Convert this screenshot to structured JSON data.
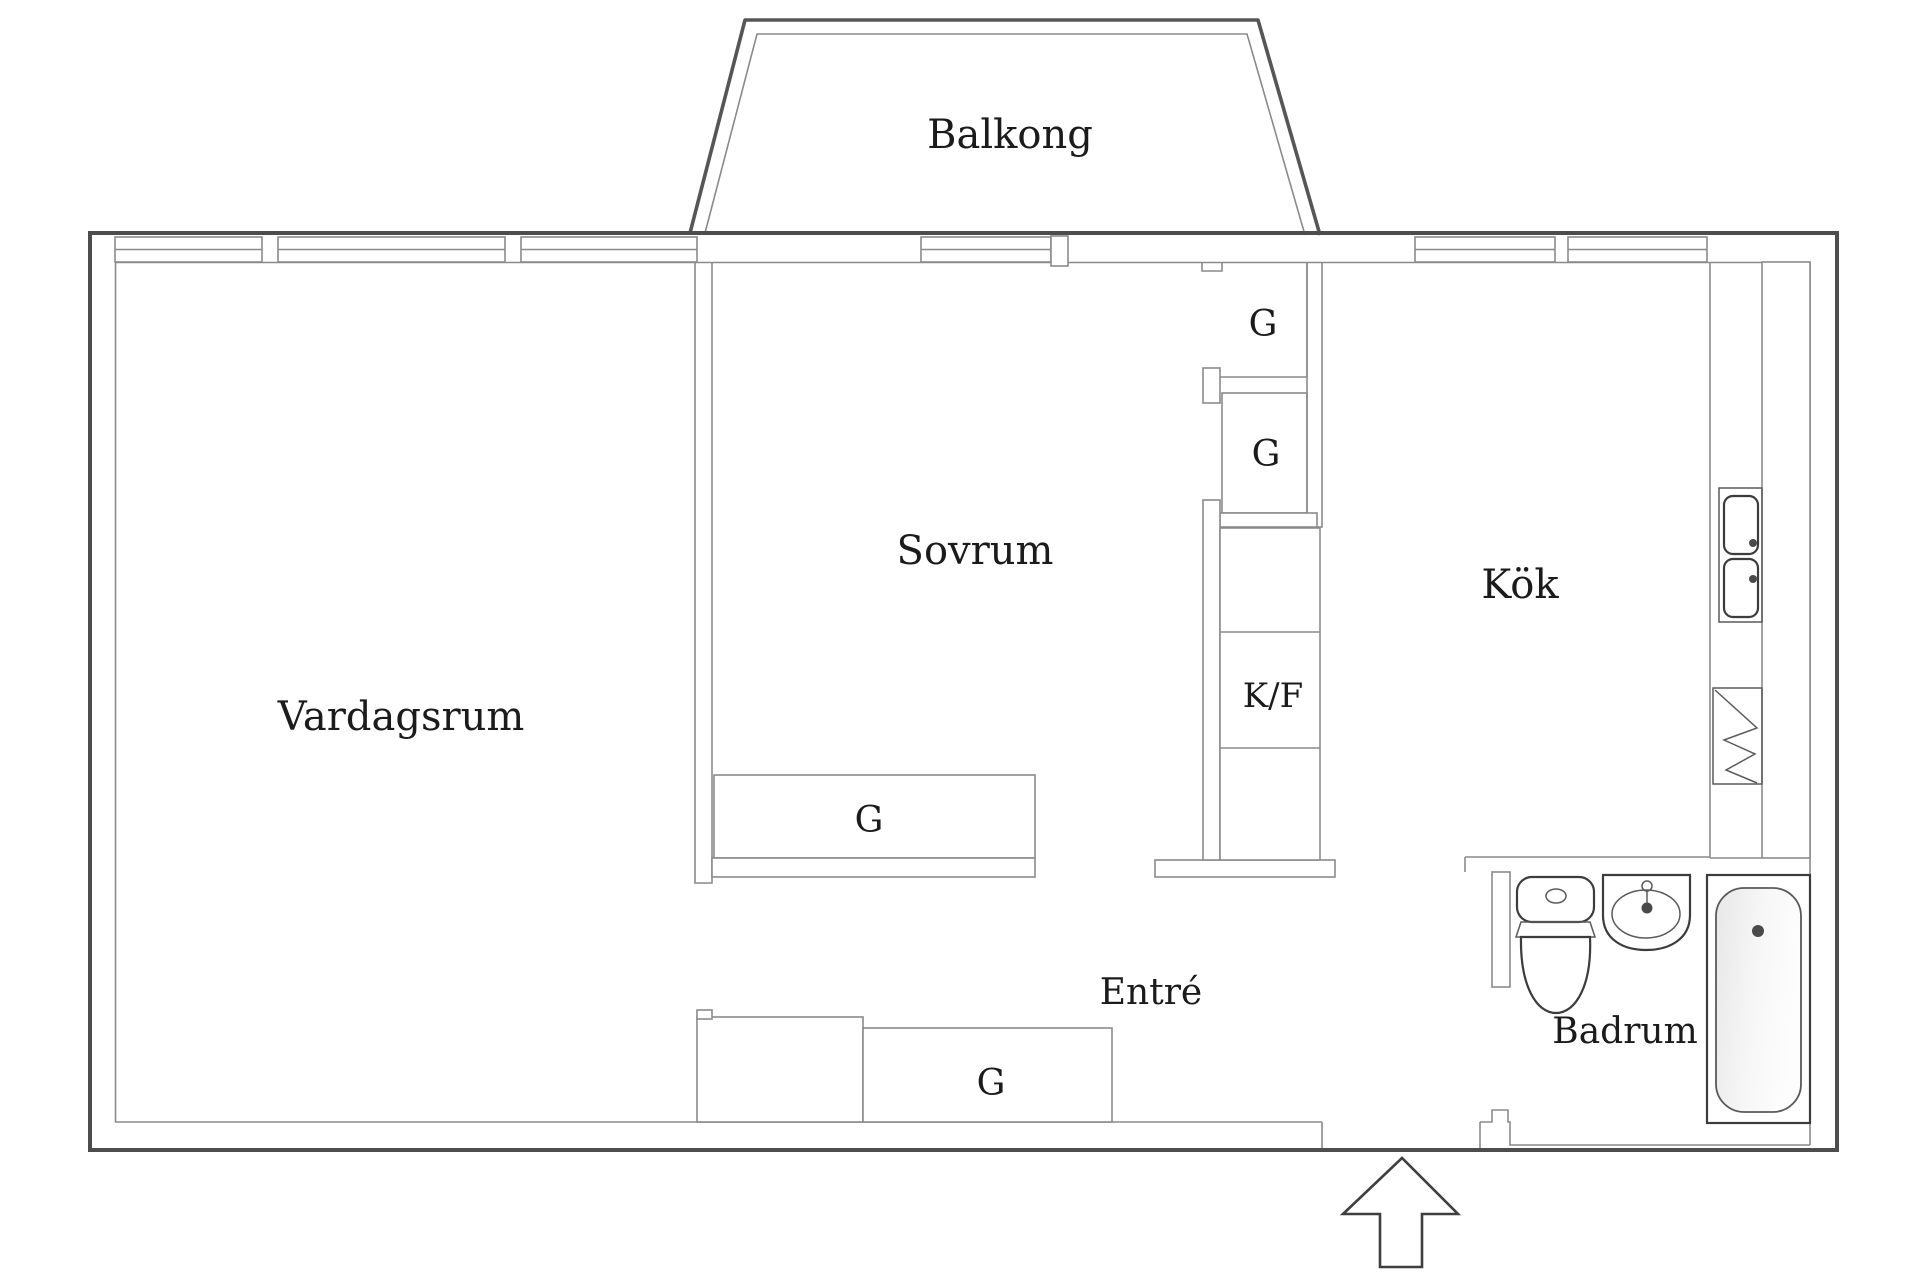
{
  "drawing_type": "apartment-floor-plan",
  "language": "sv",
  "rooms": {
    "balkong": {
      "label": "Balkong"
    },
    "vardagsrum": {
      "label": "Vardagsrum"
    },
    "sovrum": {
      "label": "Sovrum"
    },
    "kok": {
      "label": "Kök"
    },
    "entre": {
      "label": "Entré"
    },
    "badrum": {
      "label": "Badrum"
    }
  },
  "closets": {
    "wardrobe_top_1": {
      "label": "G"
    },
    "wardrobe_top_2": {
      "label": "G"
    },
    "fridge_freezer": {
      "label": "K/F"
    },
    "wardrobe_bedroom": {
      "label": "G"
    },
    "wardrobe_hall": {
      "label": "G"
    }
  },
  "icons": {
    "toilet": "toilet-icon",
    "washbasin": "washbasin-icon",
    "bathtub": "bathtub-icon",
    "kitchen_sink": "kitchen-sink-icon",
    "dishwasher": "dishwasher-icon",
    "entrance_arrow": "entrance-arrow-icon"
  },
  "colors": {
    "background": "#ffffff",
    "outer_wall": "#4d4d4d",
    "inner_line": "#8a8a8a",
    "fixture_line": "#3c3c3c",
    "text": "#1b1b1b",
    "bathtub_fill": "#ececec"
  }
}
